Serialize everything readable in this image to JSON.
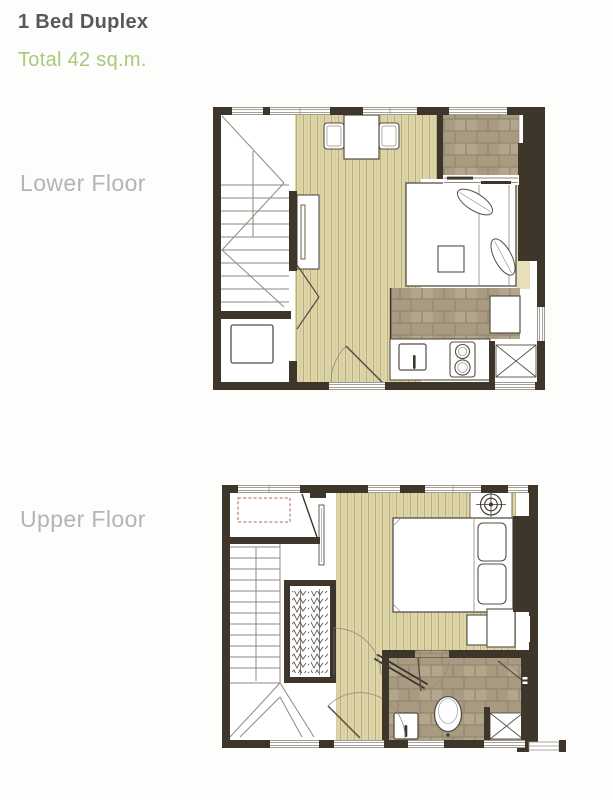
{
  "page": {
    "title": "1 Bed Duplex",
    "subtitle": "Total 42 sq.m."
  },
  "floors": [
    {
      "id": "lower",
      "label": "Lower Floor"
    },
    {
      "id": "upper",
      "label": "Upper Floor"
    }
  ],
  "colors": {
    "title_text": "#57585b",
    "subtitle_text": "#a8c97b",
    "floor_label_text": "#b2b4b6",
    "wall": "#3e352b",
    "wood_floor": "#ded6a7",
    "wood_grain": "#b9ad82",
    "tile_floor": "#a89b82",
    "tile_grout": "#8d8069",
    "fixture_outline": "#544e45",
    "page_background": "#fdfdfb"
  }
}
